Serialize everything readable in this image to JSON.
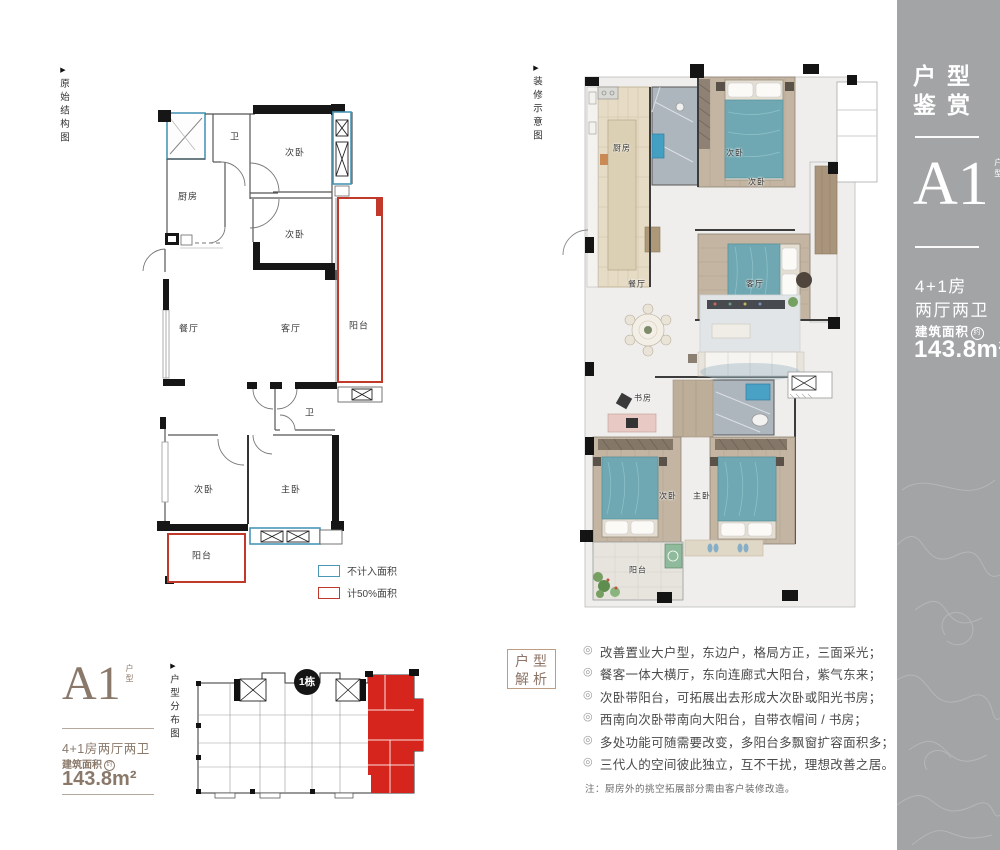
{
  "sidebar": {
    "title_line1": "户型",
    "title_line2": "鉴赏",
    "unit_code": "A1",
    "unit_tag": "户型",
    "spec_line1": "4+1房",
    "spec_line2": "两厅两卫",
    "area_label": "建筑面积",
    "area_circle": "约",
    "area_value": "143.8m²"
  },
  "plan_original": {
    "caption": "原始结构图",
    "rooms": [
      "厨房",
      "卫",
      "次卧",
      "次卧",
      "餐厅",
      "客厅",
      "阳台",
      "卫",
      "次卧",
      "主卧",
      "阳台"
    ],
    "legend": [
      {
        "label": "不计入面积",
        "color": "#4a97b8"
      },
      {
        "label": "计50%面积",
        "color": "#c0392b"
      }
    ]
  },
  "plan_decorated": {
    "caption": "装修示意图",
    "rooms": [
      "厨房",
      "次卧",
      "次卧",
      "餐厅",
      "客厅",
      "书房",
      "次卧",
      "主卧",
      "阳台"
    ]
  },
  "unit_card": {
    "unit_code": "A1",
    "unit_tag": "户型",
    "spec": "4+1房两厅两卫",
    "area_label": "建筑面积",
    "area_circle": "约",
    "area_value": "143.8m²"
  },
  "distribution": {
    "caption": "户型分布图",
    "badge": "1栋"
  },
  "analysis": {
    "box_line1": "户型",
    "box_line2": "解析",
    "bullets": [
      "改善置业大户型，东边户，格局方正，三面采光；",
      "餐客一体大横厅，东向连廊式大阳台，紫气东来；",
      "次卧带阳台，可拓展出去形成大次卧或阳光书房；",
      "西南向次卧带南向大阳台，自带衣帽间 / 书房；",
      "多处功能可随需要改变，多阳台多飘窗扩容面积多；",
      "三代人的空间彼此独立，互不干扰，理想改善之居。"
    ],
    "note": "注：厨房外的挑空拓展部分需由客户装修改造。"
  },
  "colors": {
    "sidebar_bg": "#a2a4a6",
    "accent_taupe": "#8a796b",
    "legend_blue": "#4a97b8",
    "legend_red": "#c0392b",
    "highlight_red": "#d6251d"
  }
}
